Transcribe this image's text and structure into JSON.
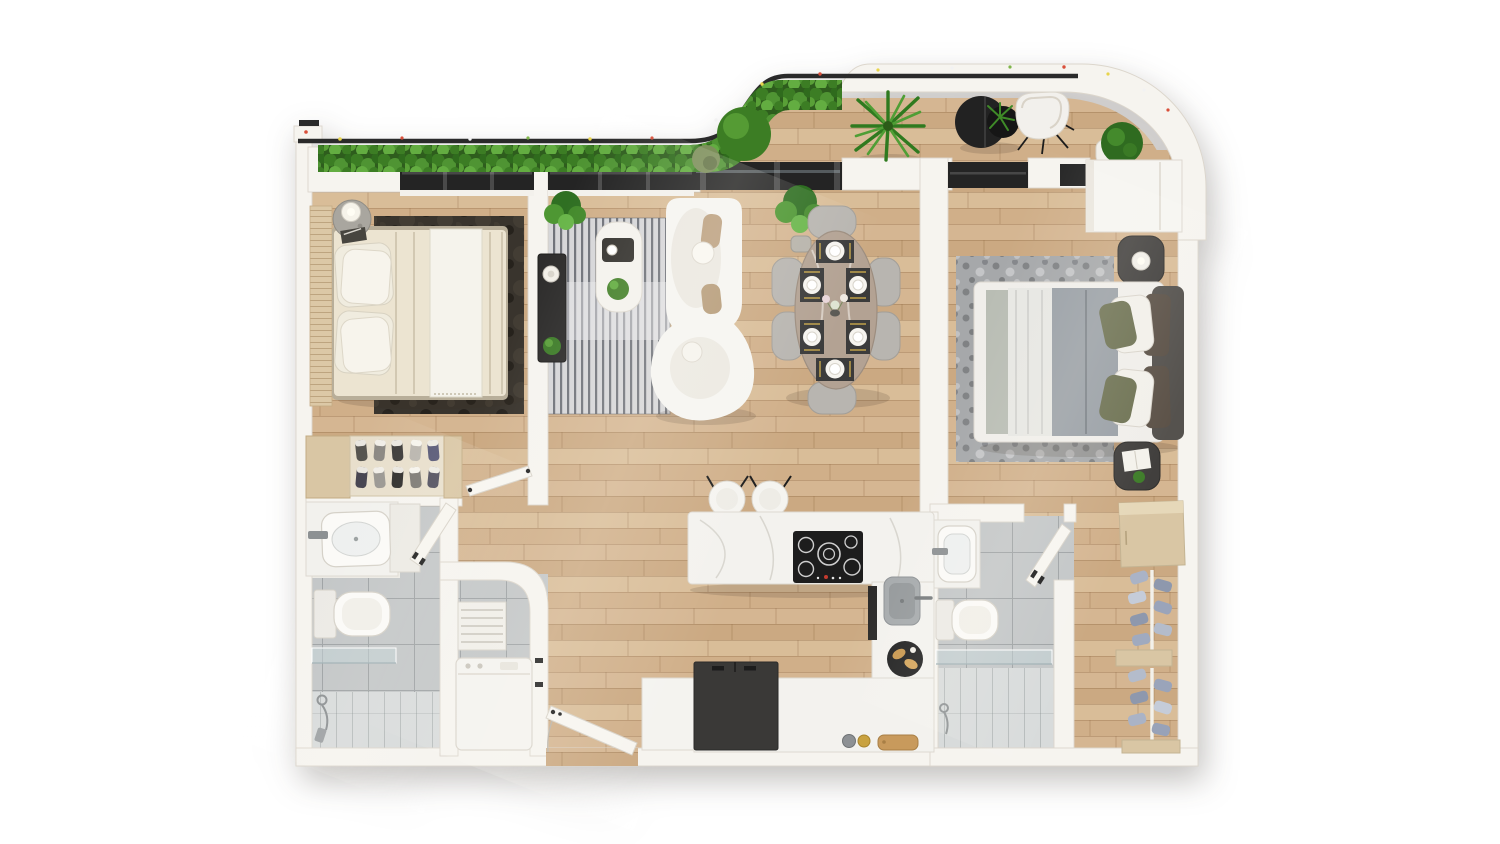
{
  "scene": {
    "description": "Top-down 3D rendered floor plan of a two-bedroom two-bathroom apartment with a curved planted balcony terrace",
    "view": "top-down-3d-render",
    "canvas": {
      "width": 1500,
      "height": 844
    }
  },
  "palette": {
    "background": "#ffffff",
    "wall": "#f6f4ef",
    "wall_stroke": "#dcd6cc",
    "wall_shade": "#e9e5dd",
    "wood_base": "#d2b28b",
    "tile": "#c3c6c7",
    "tile_light": "#d9dcdc",
    "window_dark": "#242424",
    "rail_dark": "#2a2a2a",
    "glass": "rgba(196,212,216,0.5)",
    "hedge_base": "#2e5d1d",
    "hedge_mid": "#4f9433",
    "hedge_light": "#6cb84e",
    "marble_white": "#f3f2ee",
    "marble_taupe": "#b3a293",
    "rug_bedroom1": "#39342d",
    "rug_living": "#d6d6d8",
    "rug_living_stripe": "#5c6068",
    "rug_bedroom2": "#a6a8aa",
    "cream_bedding": "#ece4d1",
    "linen_white": "#f5f3ec",
    "gray_duvet": "#9aa0a6",
    "sage": "#b9bdb4",
    "olive_pillow": "#6e7253",
    "brown_pillow": "#5c5248",
    "tan_cushion": "#bb9f7e",
    "tan_wood": "#d9c6a4",
    "charcoal_furniture": "#2e2d2c",
    "appliance_white": "#f4f3ef",
    "appliance_dark": "#3a3937",
    "metal_gray": "#8d9193",
    "gold": "#c9a23f",
    "stone": "#a9a69f"
  },
  "rooms": [
    {
      "id": "balcony-terrace",
      "floor": "wood",
      "furniture": [
        "privacy-hedge",
        "balcony-rail",
        "bistro-table",
        "table-fern",
        "lounge-chair",
        "palm-plant",
        "boxwood-planter",
        "topiary-bush",
        "olive-bush",
        "flower-specks"
      ]
    },
    {
      "id": "bedroom-1",
      "floor": "wood",
      "furniture": [
        "double-bed-cream",
        "slatted-headboard",
        "pillow-stacks",
        "stone-side-table",
        "table-lamp",
        "magazine",
        "dark-area-rug",
        "shoe-rack",
        "sneakers",
        "interior-door"
      ]
    },
    {
      "id": "bathroom-1",
      "floor": "tile",
      "furniture": [
        "vanity-counter",
        "rectangular-sink",
        "wall-faucet",
        "toilet",
        "glass-shower-screen",
        "hand-shower",
        "shower-floor",
        "interior-door"
      ]
    },
    {
      "id": "laundry-closet",
      "floor": "tile",
      "furniture": [
        "drying-rack",
        "washing-machine",
        "door-jamb-stops"
      ]
    },
    {
      "id": "living-room",
      "floor": "wood",
      "furniture": [
        "tv-console",
        "decor-bowl",
        "console-plant",
        "potted-plant",
        "striped-rug",
        "coffee-table",
        "serving-tray",
        "coffee-cup",
        "table-plant",
        "curved-sofa",
        "throw-cushions"
      ]
    },
    {
      "id": "dining-area",
      "floor": "wood",
      "furniture": [
        "oval-marble-table",
        "dining-chairs",
        "place-settings",
        "flower-centerpiece",
        "potted-plant"
      ]
    },
    {
      "id": "kitchen",
      "floor": "wood",
      "furniture": [
        "marble-island",
        "cooktop",
        "bar-stools",
        "sink",
        "faucet",
        "oven-front",
        "pastry-tray",
        "refrigerator",
        "base-cabinet",
        "perimeter-counter",
        "cutting-board",
        "canister",
        "gold-jar"
      ]
    },
    {
      "id": "entry",
      "floor": "wood",
      "furniture": [
        "entry-door",
        "door-swing-arc"
      ]
    },
    {
      "id": "bedroom-2",
      "floor": "wood",
      "furniture": [
        "double-bed-gray",
        "upholstered-headboard",
        "pillow-rows",
        "nightstand-with-lamp",
        "nightstand-with-book",
        "small-plant",
        "wardrobe",
        "mottled-area-rug"
      ]
    },
    {
      "id": "bathroom-2",
      "floor": "tile",
      "furniture": [
        "vanity-sink",
        "wall-faucet",
        "toilet",
        "glass-shower-screen",
        "hand-shower",
        "shower-floor",
        "interior-door"
      ]
    },
    {
      "id": "walk-in-closet",
      "floor": "wood",
      "furniture": [
        "dresser",
        "shoe-shelf-upper",
        "shoe-shelf-lower",
        "shelf-boards",
        "shoes"
      ]
    }
  ],
  "counts": {
    "bedrooms": 2,
    "bathrooms": 2,
    "dining_chairs": 6,
    "place_settings": 6,
    "bar_stools": 2,
    "sneaker_pairs_bedroom1": 10,
    "shoe_pairs_closet": 12,
    "burners": 5
  }
}
